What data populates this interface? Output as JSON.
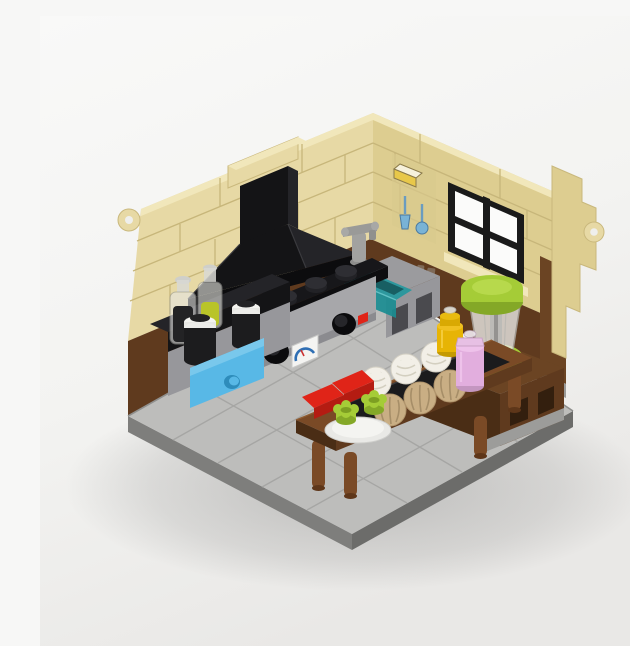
{
  "meta": {
    "description": "Isometric product render of a LEGO miniature kitchen diorama: tan brick walls with clip rings, black range hood over a silver stove, teal sink with faucet, azure drawer, spice jars and bottles, a food processor with lime-green lid on a brown counter, and a brown bakery table holding white and tan swirl rolls, red boxes, lime cups on a plate, a yellow jar and a pink jar, all on a gray tiled base."
  },
  "scene": {
    "objects": [
      "tan-brick-left-wall",
      "tan-brick-right-wall",
      "window",
      "wall-print-tile",
      "range-hood",
      "cooktop",
      "stove-oven",
      "black-countertop",
      "spice-bottles",
      "black-jars",
      "azure-drawer",
      "sink-basin",
      "faucet",
      "brown-wainscot",
      "side-counter",
      "food-processor",
      "dining-table",
      "bread-tray",
      "white-rolls",
      "tan-rolls",
      "red-boxes",
      "plate-with-cups",
      "yellow-jar",
      "pink-jar",
      "tiled-floor",
      "base-rim",
      "clip-rings"
    ]
  },
  "palette": {
    "bg": "#f7f7f6",
    "bg2": "#eae9e7",
    "tan": "#e7d9a5",
    "tan2": "#ddcd90",
    "tan_light": "#f1e7bb",
    "tan_line": "#c7b67a",
    "tan_print": "#d8c98e",
    "brown": "#5f3a1e",
    "brown_dark": "#4a2d15",
    "brown_mid": "#6b4423",
    "brown_table": "#7a4a26",
    "floor": "#bdbdbb",
    "floor_line": "#a6a6a4",
    "rim": "#7e7e7c",
    "rim2": "#6c6c6a",
    "black": "#141416",
    "black2": "#242428",
    "black3": "#0c0c0e",
    "silver": "#a7a7aa",
    "silver_dark": "#8b8b8f",
    "gray_cab": "#97979b",
    "gray_slot": "#4a4a4e",
    "azure": "#58b8e6",
    "azure_dark": "#2e8cbb",
    "azure_light": "#79c8ec",
    "teal": "#1b8d92",
    "teal_dark": "#0d5a5e",
    "teal_light": "#25989e",
    "lime": "#a5cc37",
    "lime_dark": "#84a827",
    "lime_pale": "#b7d94c",
    "red": "#e02418",
    "red_dark": "#b41c12",
    "bun_white": "#f2efe7",
    "bun_white_line": "#d3cfc0",
    "bun_tan": "#c9ae84",
    "bun_tan_line": "#a68e68",
    "yellow": "#e7b405",
    "yellow_dark": "#c49a03",
    "yellow_light": "#f0c020",
    "pink": "#e2aede",
    "pink_dark": "#c496c0",
    "pink_light": "#eec2ea",
    "glass": "#ececea",
    "glass_line": "#b2b2ae",
    "frame": "#1a1a1a",
    "pane": "#fbfbfa",
    "print_blue": "#79b3d6",
    "print_yellow": "#e8c84a"
  }
}
